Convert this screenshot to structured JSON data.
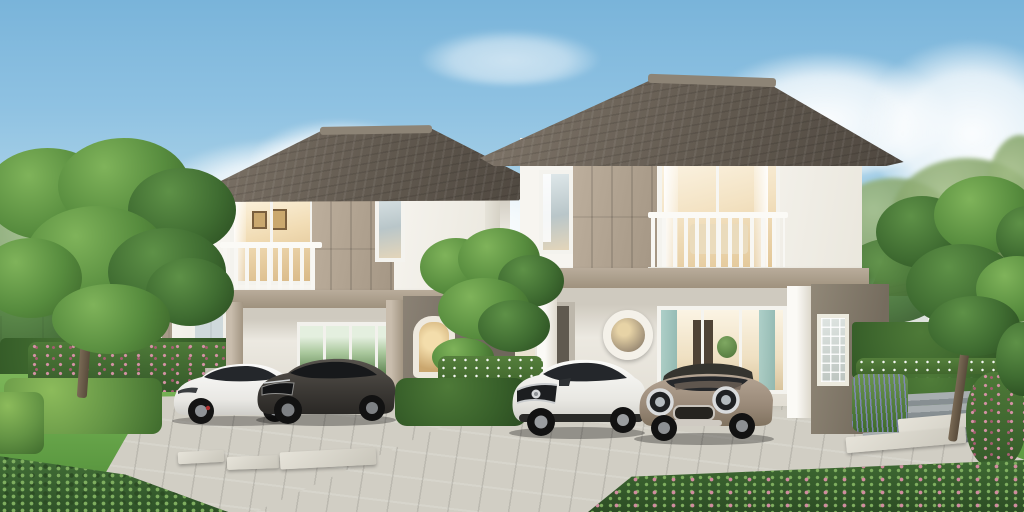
{
  "scene": {
    "description": "Daylight 3D architectural rendering of two modern two-storey detached houses with open carports, balconies and landscaped front gardens; four cars are parked under the carports; paved driveways, trimmed hedges, flower beds and background houses under a blue sky with soft clouds",
    "sky": {
      "label": "blue sky with soft white clouds",
      "top_color": "#79b4da",
      "horizon_color": "#ece3cf"
    },
    "objects": {
      "left_house": {
        "label": "left two-storey house: dark hip roof, white walls, taupe panel accent, balcony with white railing, open carport, arched side window"
      },
      "right_house": {
        "label": "right two-storey house: dark hip roof, white walls, taupe panel accent, balcony with white railing, open carport, round porthole window, glass-block side panel"
      },
      "background_house_left": {
        "label": "distant house with grey hip roof behind trees on the left"
      },
      "background_houses_right": {
        "label": "distant houses with brown tiled roofs behind trees on the right"
      },
      "car_white_sedan": {
        "label": "white electric sedan parked in left carport",
        "color": "#f1f1ef"
      },
      "car_grey_wagon": {
        "label": "dark grey fastback wagon parked in left carport",
        "color": "#45423e"
      },
      "car_white_suv": {
        "label": "white compact crossover SUV parked in right carport",
        "color": "#f1f1ef"
      },
      "car_bronze_mini": {
        "label": "bronze hatchback with dark roof and round headlights parked in right carport",
        "color": "#a59381"
      },
      "fence": {
        "label": "low white boundary wall with hedges"
      },
      "left_tree": {
        "label": "large leafy tree at left edge"
      },
      "middle_tree": {
        "label": "small tree between the two houses"
      },
      "right_tree": {
        "label": "plumeria-style tree at right edge"
      },
      "lawn": {
        "label": "green lawn"
      },
      "driveways": {
        "label": "light concrete paver driveways with stepping slabs"
      },
      "steps": {
        "label": "grey garden steps on the right"
      },
      "flower_beds": {
        "label": "pink and white flower beds, lavender and trimmed box hedges"
      }
    },
    "palette": {
      "roof": "#625a50",
      "wall": "#f7f5f0",
      "accent_panel": "#b3a593",
      "floor_band": "#a99c8c",
      "side_wall": "#837a6d",
      "railing": "#f8f7f3",
      "warm_glass": "#f1dcb4",
      "teal_curtain": "#9cc4bd",
      "lawn": "#6aa84c",
      "hedge": "#38602a",
      "flower_pink": "#c97f93",
      "paving": "#d1cec4",
      "step_grey": "#878f92",
      "lavender": "#8187bd",
      "tire": "#1c1c1c"
    }
  }
}
